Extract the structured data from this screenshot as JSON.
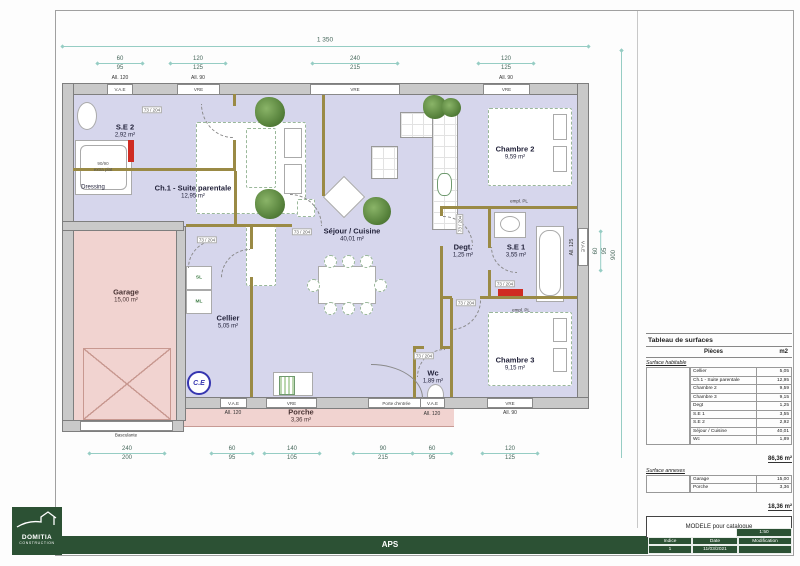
{
  "plan": {
    "rooms": [
      {
        "name": "S.E 2",
        "area": "2,92 m²"
      },
      {
        "name": "Ch.1 - Suite parentale",
        "area": "12,95 m²"
      },
      {
        "name": "Dressing",
        "area": ""
      },
      {
        "name": "Séjour / Cuisine",
        "area": "40,01 m²"
      },
      {
        "name": "Chambre 2",
        "area": "9,59 m²"
      },
      {
        "name": "Degt.",
        "area": "1,25 m²"
      },
      {
        "name": "S.E 1",
        "area": "3,55 m²"
      },
      {
        "name": "Chambre 3",
        "area": "9,15 m²"
      },
      {
        "name": "Cellier",
        "area": "5,05 m²"
      },
      {
        "name": "Wc",
        "area": "1,89 m²"
      },
      {
        "name": "Garage",
        "area": "15,00 m²"
      },
      {
        "name": "Porche",
        "area": "3,36 m²"
      }
    ],
    "windows": {
      "vae": "V.A.E",
      "vre": "VRE",
      "basculante": "Basculante",
      "porte_entree": "Porte d'entrée"
    },
    "allege": {
      "a90": "All. 90",
      "a120": "All. 120",
      "a125": "All. 125"
    },
    "dims": {
      "overall_width": "1 350",
      "overall_height": "900",
      "top": [
        {
          "w": "60",
          "h": "95"
        },
        {
          "w": "120",
          "h": "125"
        },
        {
          "w": "240",
          "h": "215"
        },
        {
          "w": "120",
          "h": "125"
        }
      ],
      "bottom": [
        {
          "w": "240",
          "h": "200"
        },
        {
          "w": "60",
          "h": "95"
        },
        {
          "w": "140",
          "h": "105"
        },
        {
          "w": "90",
          "h": "215"
        },
        {
          "w": "60",
          "h": "95"
        },
        {
          "w": "120",
          "h": "125"
        }
      ],
      "right": {
        "w": "60",
        "h": "95"
      }
    },
    "misc": {
      "door_size": "73 / 204",
      "shower_line1": "90/90",
      "shower_line2": "extra plat",
      "sl": "SL",
      "ml": "ML",
      "ce": "C.E",
      "empl_pl": "empl. PL"
    }
  },
  "surface_table": {
    "title": "Tableau de surfaces",
    "col_pieces": "Pièces",
    "col_unit": "m2",
    "habitable_label": "Surface habitable",
    "habitable_rows": [
      {
        "name": "Cellier",
        "value": "5,05"
      },
      {
        "name": "Ch.1 - Suite parentale",
        "value": "12,95"
      },
      {
        "name": "Chambre 2",
        "value": "9,59"
      },
      {
        "name": "Chambre 3",
        "value": "9,15"
      },
      {
        "name": "Degt",
        "value": "1,25"
      },
      {
        "name": "S.E 1",
        "value": "3,55"
      },
      {
        "name": "S.E 2",
        "value": "2,92"
      },
      {
        "name": "Séjour / Cuisine",
        "value": "40,01"
      },
      {
        "name": "Wc",
        "value": "1,89"
      }
    ],
    "habitable_total": "86,36 m²",
    "annexes_label": "Surface annexes",
    "annexes_rows": [
      {
        "name": "Garage",
        "value": "15,00"
      },
      {
        "name": "Porche",
        "value": "3,36"
      }
    ],
    "annexes_total": "18,36 m²"
  },
  "title_block": {
    "company": "DOMITIA",
    "company_sub": "CONSTRUCTION",
    "phase": "APS",
    "project": "MODELE pour catalogue",
    "scale": "1:50",
    "col_indice": "Indice",
    "col_date": "Date",
    "col_modification": "Modification",
    "indice": "1",
    "date": "11/03/2021",
    "modification": ""
  },
  "colors": {
    "accent_green": "#2c5134",
    "floor": "#d6d6ec",
    "annex": "#f1d3d0"
  }
}
